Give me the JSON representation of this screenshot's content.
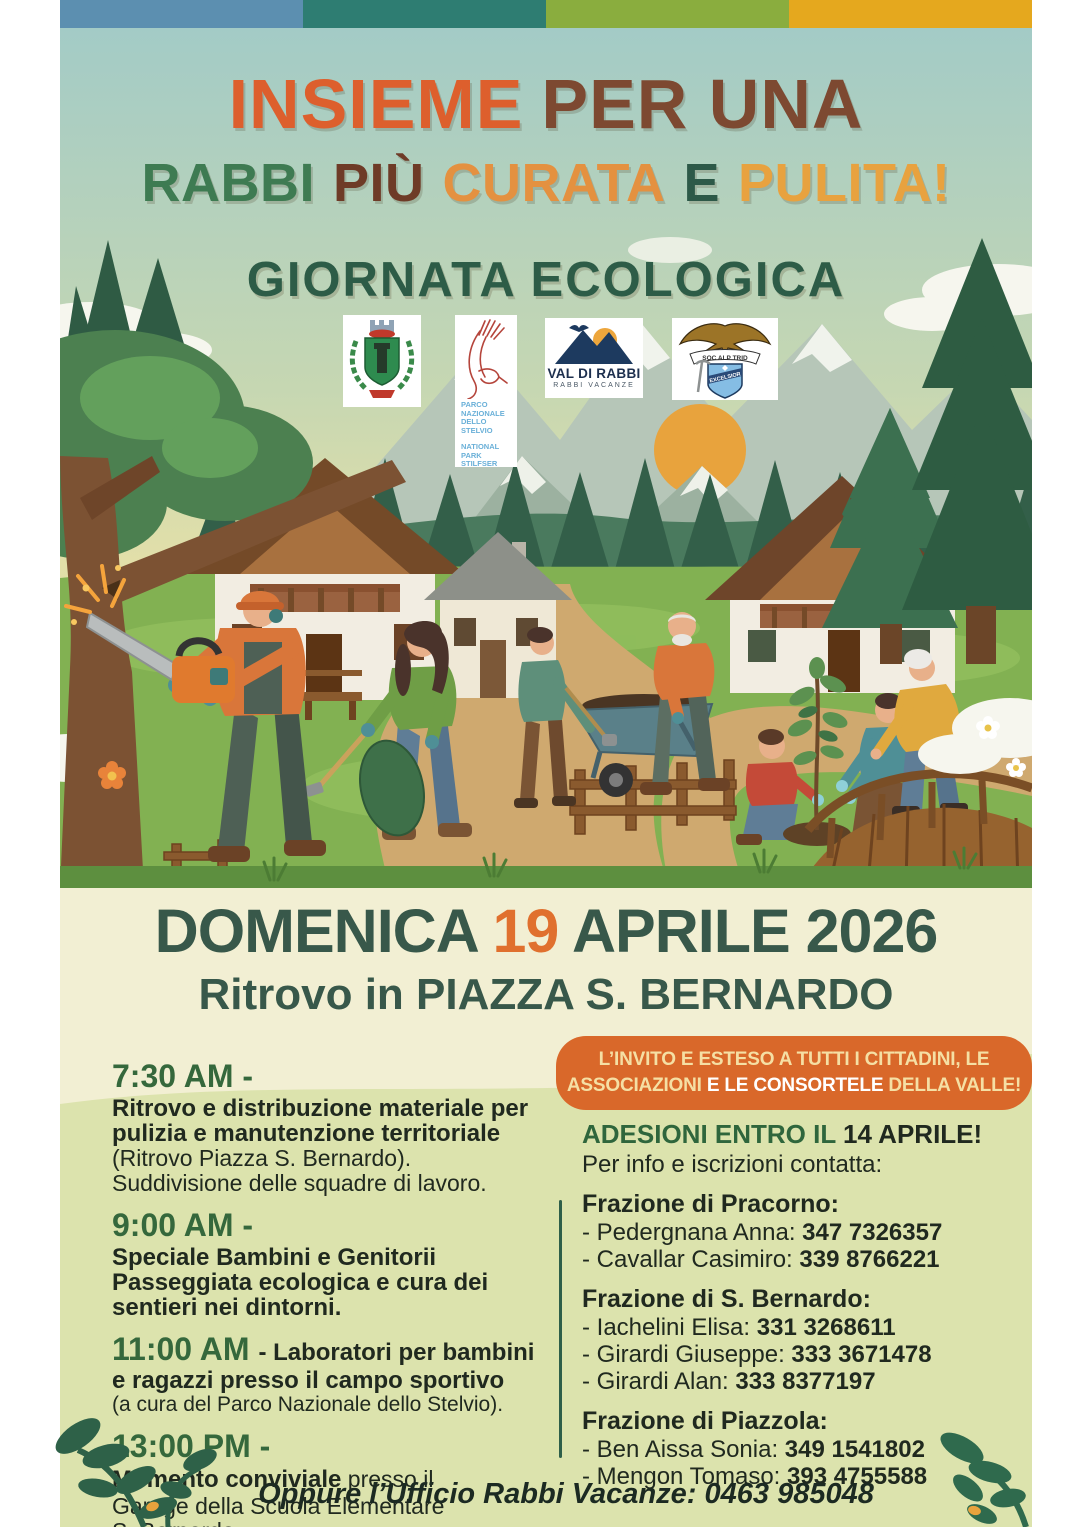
{
  "colors": {
    "bar_blue": "#5c8fb0",
    "bar_teal": "#2e7d72",
    "bar_green": "#8aad3e",
    "bar_yellow": "#e5a81e",
    "title_orange": "#dd5f2d",
    "title_brown": "#7d4931",
    "title_green": "#3e7b52",
    "title_dark_brown": "#6e3b27",
    "title_amber": "#e49140",
    "title_dark_green": "#2d5c47",
    "date_green": "#38584a",
    "date_orange": "#e0702e",
    "banner_bg": "#d9682a",
    "banner_cream": "#f5dfa4",
    "banner_white": "#ffffff",
    "cream_band": "#f2efd3",
    "section_bg": "#dce3ad",
    "time_green": "#35683c",
    "text_dark": "#20291f"
  },
  "title": {
    "word1": "INSIEME",
    "word2": "PER UNA",
    "word3": "RABBI",
    "word4": "PIÙ",
    "word5": "CURATA",
    "word6": "E",
    "word7": "PULITA!",
    "subtitle": "GIORNATA ECOLOGICA"
  },
  "logos": {
    "stelvio": {
      "line1": "PARCO NAZIONALE DELLO STELVIO",
      "line2": "NATIONAL PARK STILFSER JOCH"
    },
    "valdirabbi": {
      "line1": "VAL DI RABBI",
      "line2": "RABBI VACANZE"
    },
    "sat": {
      "ribbon": "SOC ALP TRID",
      "shield": "EXCELSIOR"
    }
  },
  "date_banner": {
    "day_label": "DOMENICA ",
    "day_number": "19",
    "month_year": " APRILE 2026",
    "line2": "Ritrovo in PIAZZA S. BERNARDO"
  },
  "invite": {
    "line1": "L’INVITO E ESTESO A TUTTI I CITTADINI, LE",
    "line2_a": "ASSOCIAZIONI ",
    "line2_b": "E LE CONSORTELE ",
    "line2_c": "DELLA VALLE!"
  },
  "schedule": {
    "e1": {
      "time": "7:30 AM -",
      "bold_lines": [
        "Ritrovo e distribuzione materiale per",
        "pulizia e manutenzione territoriale"
      ],
      "normal_lines": [
        "(Ritrovo Piazza S. Bernardo).",
        "Suddivisione delle squadre di lavoro."
      ]
    },
    "e2": {
      "time": "9:00 AM -",
      "bold_lines": [
        "Speciale Bambini e Genitorii",
        "Passeggiata ecologica e cura dei",
        "sentieri nei dintorni."
      ]
    },
    "e3": {
      "time": "11:00 AM ",
      "bold_line1": "- Laboratori per bambini",
      "bold_line2": "e ragazzi presso il campo sportivo",
      "note": "(a cura del Parco Nazionale dello Stelvio)."
    },
    "e4": {
      "time": "13:00 PM -",
      "bold": "Momento conviviale",
      "normal_tail": " presso il",
      "normal_lines": [
        "Garage della Scuola Elementare",
        "S. Bernardo."
      ]
    }
  },
  "contacts": {
    "header_green": "ADESIONI ENTRO IL ",
    "header_dark": "14 APRILE!",
    "sub": "Per info e iscrizioni contatta:",
    "groups": [
      {
        "title": "Frazione di Pracorno:",
        "entries": [
          {
            "name": "- Pedergnana Anna: ",
            "phone": "347 7326357"
          },
          {
            "name": "- Cavallar Casimiro: ",
            "phone": "339 8766221"
          }
        ]
      },
      {
        "title": "Frazione di S. Bernardo:",
        "entries": [
          {
            "name": "- Iachelini Elisa: ",
            "phone": "331 3268611"
          },
          {
            "name": "- Girardi Giuseppe: ",
            "phone": "333 3671478"
          },
          {
            "name": "- Girardi Alan: ",
            "phone": "333 8377197"
          }
        ]
      },
      {
        "title": "Frazione di Piazzola:",
        "entries": [
          {
            "name": "- Ben Aissa Sonia: ",
            "phone": "349 1541802"
          },
          {
            "name": "- Mengon Tomaso: ",
            "phone": "393 4755588"
          }
        ]
      }
    ]
  },
  "footer": {
    "text": "Oppure l’Ufficio Rabbi Vacanze: ",
    "phone": "0463 985048"
  }
}
